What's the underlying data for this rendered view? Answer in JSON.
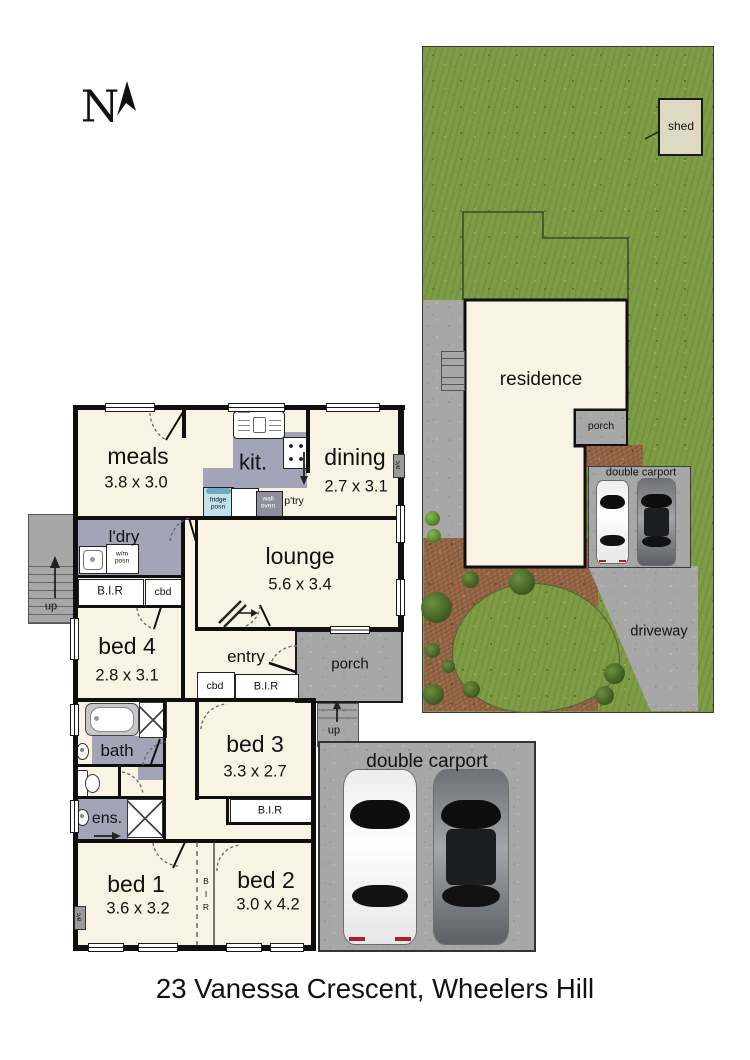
{
  "page": {
    "address": "23 Vanessa Crescent, Wheelers Hill",
    "north": "N"
  },
  "site": {
    "shed": "shed",
    "residence": "residence",
    "porch": "porch",
    "carport": "double carport",
    "driveway": "driveway"
  },
  "plan": {
    "meals": {
      "name": "meals",
      "dims": "3.8 x 3.0"
    },
    "kit": {
      "name": "kit."
    },
    "dining": {
      "name": "dining",
      "dims": "2.7 x 3.1"
    },
    "lounge": {
      "name": "lounge",
      "dims": "5.6 x 3.4"
    },
    "ldry": {
      "name": "l'dry"
    },
    "bed4": {
      "name": "bed 4",
      "dims": "2.8 x 3.1"
    },
    "entry": {
      "name": "entry"
    },
    "porch": {
      "name": "porch"
    },
    "bed3": {
      "name": "bed 3",
      "dims": "3.3 x 2.7"
    },
    "bath": {
      "name": "bath"
    },
    "ens": {
      "name": "ens."
    },
    "bed1": {
      "name": "bed 1",
      "dims": "3.6 x 3.2"
    },
    "bed2": {
      "name": "bed 2",
      "dims": "3.0 x 4.2"
    },
    "carport": {
      "name": "double carport"
    },
    "labels": {
      "fridge": "fridge posn",
      "wall_oven": "wall oven",
      "pantry": "p'try",
      "wm": "w/m posn",
      "bir": "B.I.R",
      "cbd": "cbd",
      "up": "up",
      "ac": "a/c",
      "bir_v": "B I R"
    }
  },
  "colors": {
    "grass": "#7e9c45",
    "mulch": "#9a6b4c",
    "concrete": "#a7a7a7",
    "floor": "#f8f3e2",
    "wet_area": "#a4a4b8",
    "walls": "#0f0f0f",
    "fridge": "#bfe2ec"
  }
}
